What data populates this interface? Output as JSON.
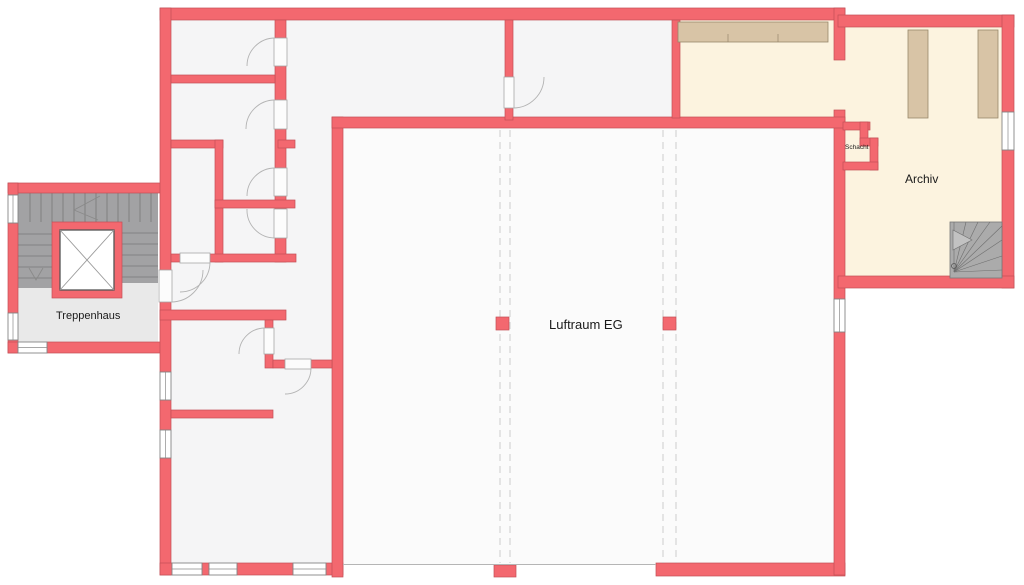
{
  "plan": {
    "type": "architectural-floor-plan",
    "labels": {
      "treppenhaus": "Treppenhaus",
      "luftraum": "Luftraum EG",
      "archiv": "Archiv",
      "schacht": "Schacht"
    }
  },
  "colors": {
    "page": "#FFFFFF",
    "wall": "#F3686F",
    "wallStroke": "#C24F55",
    "floor": "#F5F5F6",
    "voidFloor": "#FBFBFB",
    "cream": "#FCF3DF",
    "shelf": "#D8C4A6",
    "shelfStroke": "#97876C",
    "stairDark": "#A2A2A4",
    "stairLight": "#E9E9E9",
    "spiral": "#ABABAB"
  }
}
